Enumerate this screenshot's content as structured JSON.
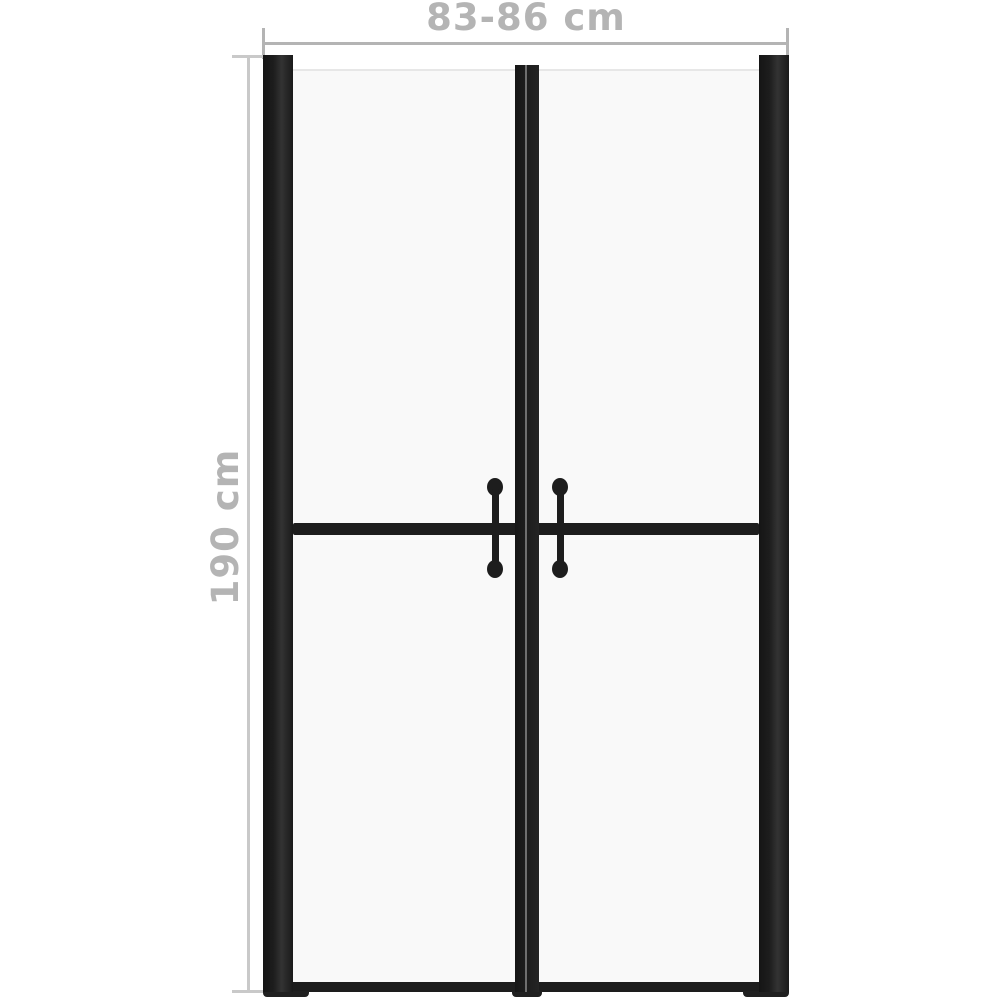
{
  "diagram": {
    "kind": "shower-door-dimension-diagram",
    "dimensions": {
      "width": {
        "label": "83-86 cm"
      },
      "height": {
        "label": "190 cm"
      }
    },
    "door": {
      "glass_panels": 2,
      "handles": 2,
      "parts": [
        "left-frame-post",
        "right-frame-post",
        "center-stiles",
        "mid-rail",
        "bottom-rail",
        "glass-panel-left",
        "glass-panel-right",
        "handle-left",
        "handle-right"
      ]
    },
    "colors": {
      "frame": "#1d1d1d",
      "glass": "#f9f9f9",
      "dimension_gray": "#b4b4b4",
      "background": "#ffffff"
    }
  }
}
